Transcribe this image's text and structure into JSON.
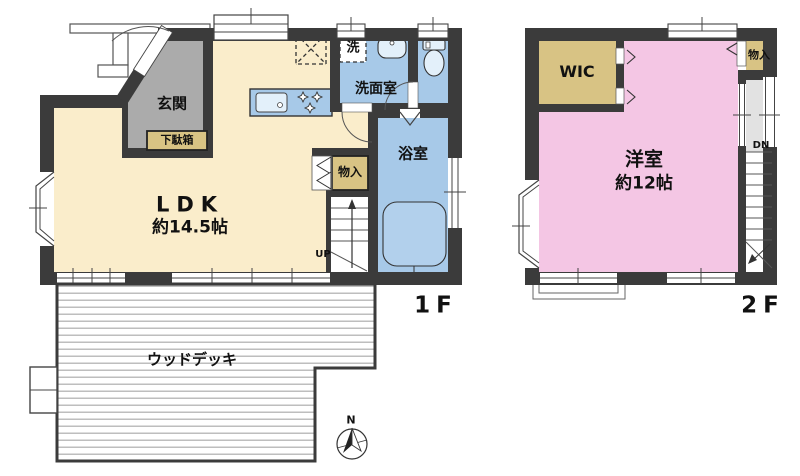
{
  "colors": {
    "wall": "#3b3b3b",
    "ldk": "#FAEDCB",
    "genkan": "#ABABAB",
    "closet": "#D8C384",
    "wet": "#A7C9E8",
    "fixture": "#E3F0FA",
    "bedroom": "#F4C6E4",
    "hall": "#E2E2E2",
    "deck": "#ADADAD"
  },
  "f1": {
    "floor_label": "1F",
    "ldk_name": "LDK",
    "ldk_area": "約14.5帖",
    "genkan": "玄関",
    "shoe_cabinet": "下駄箱",
    "washroom": "洗面室",
    "washer": "洗",
    "bathroom": "浴室",
    "storage": "物入",
    "stairs_up": "UP",
    "wood_deck": "ウッドデッキ"
  },
  "f2": {
    "floor_label": "2F",
    "room_name": "洋室",
    "room_area": "約12帖",
    "wic": "WIC",
    "storage": "物入",
    "stairs_down": "DN"
  },
  "compass": {
    "north": "N"
  },
  "icons": [
    "compass-icon",
    "toilet-icon",
    "bathtub-icon",
    "wash-basin-icon",
    "kitchen-sink-icon",
    "stove-burners-icon",
    "refrigerator-dashed-icon",
    "washing-machine-dashed-icon",
    "stairs-up-icon",
    "stairs-down-icon",
    "door-arc-icon",
    "window-icon",
    "bifold-door-icon"
  ]
}
